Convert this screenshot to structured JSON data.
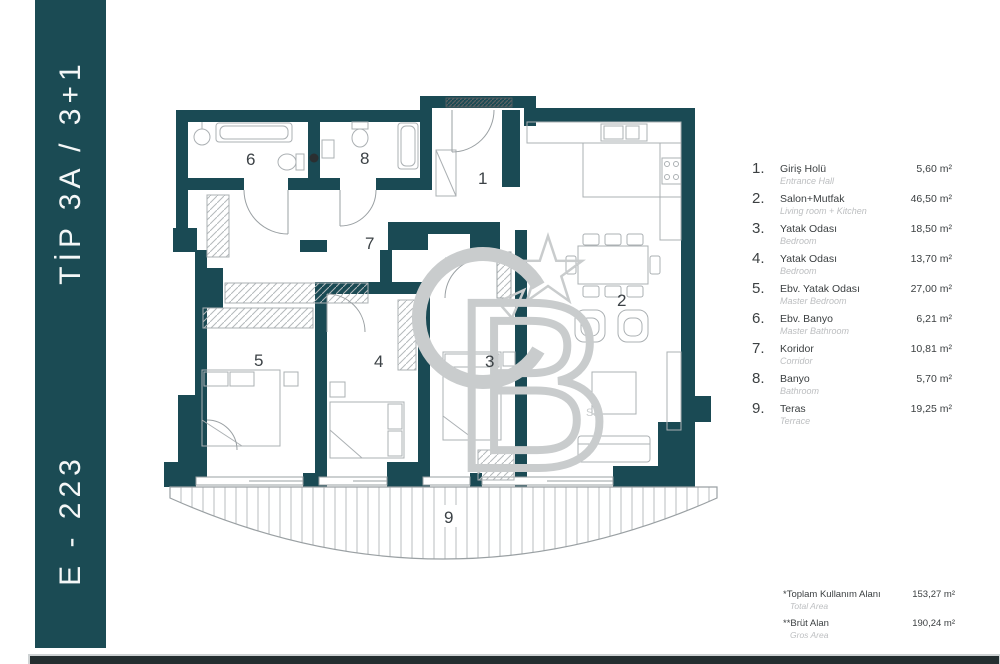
{
  "banner": {
    "type_label": "TİP 3A / 3+1",
    "unit_label": "E - 223"
  },
  "plan": {
    "room_labels": [
      "1",
      "2",
      "3",
      "4",
      "5",
      "6",
      "7",
      "8",
      "9"
    ]
  },
  "watermark": {
    "c": "C",
    "b": "B",
    "sm": "SM"
  },
  "legend": {
    "items": [
      {
        "no": "1.",
        "name": "Giriş Holü",
        "name_en": "Entrance Hall",
        "area": "5,60 m²"
      },
      {
        "no": "2.",
        "name": "Salon+Mutfak",
        "name_en": "Living room + Kitchen",
        "area": "46,50 m²"
      },
      {
        "no": "3.",
        "name": "Yatak Odası",
        "name_en": "Bedroom",
        "area": "18,50 m²"
      },
      {
        "no": "4.",
        "name": "Yatak Odası",
        "name_en": "Bedroom",
        "area": "13,70 m²"
      },
      {
        "no": "5.",
        "name": "Ebv. Yatak Odası",
        "name_en": "Master Bedroom",
        "area": "27,00 m²"
      },
      {
        "no": "6.",
        "name": "Ebv. Banyo",
        "name_en": "Master Bathroom",
        "area": "6,21 m²"
      },
      {
        "no": "7.",
        "name": "Koridor",
        "name_en": "Corridor",
        "area": "10,81 m²"
      },
      {
        "no": "8.",
        "name": "Banyo",
        "name_en": "Bathroom",
        "area": "5,70 m²"
      },
      {
        "no": "9.",
        "name": "Teras",
        "name_en": "Terrace",
        "area": "19,25 m²"
      }
    ]
  },
  "totals": {
    "rows": [
      {
        "name": "*Toplam Kullanım Alanı",
        "name_en": "Total Area",
        "area": "153,27 m²"
      },
      {
        "name": "**Brüt Alan",
        "name_en": "Gros Area",
        "area": "190,24 m²"
      }
    ]
  },
  "colors": {
    "wall": "#1a4a54",
    "banner": "#1b4b54",
    "furniture": "#abb0b3",
    "watermark": "#c9cccd"
  }
}
